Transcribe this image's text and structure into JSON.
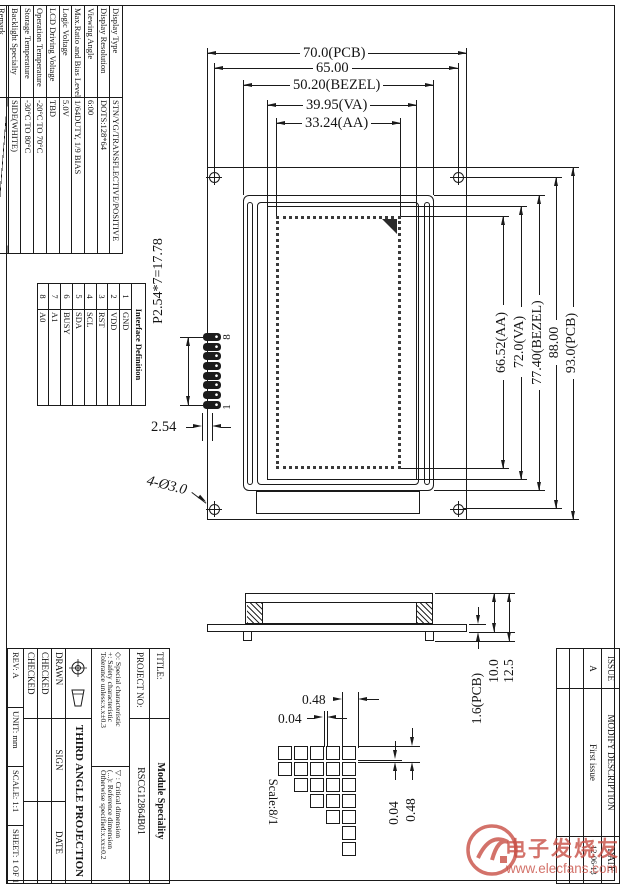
{
  "spec_table": {
    "rows": [
      {
        "label": "Display Type",
        "value": "STN/YG/TRANSFLECTIVE/POSITIVE"
      },
      {
        "label": "Display Resolution",
        "value": "DOTS:128*64"
      },
      {
        "label": "Viewing Angle",
        "value": "6:00"
      },
      {
        "label": "Max.Ratio and Bias Level",
        "value": "1/64DUTY, 1/9 BIAS"
      },
      {
        "label": "Logic Voltage",
        "value": "5.0V"
      },
      {
        "label": "LCD Driving Voltage",
        "value": "TBD"
      },
      {
        "label": "Operation Temperature",
        "value": "-20°C TO 70°C"
      },
      {
        "label": "Storage Temperature",
        "value": "-30°C TO 80°C"
      },
      {
        "label": "Backlight Specialty",
        "value": "SIDE(WHITE)"
      },
      {
        "label": "Remark",
        "value": ""
      }
    ]
  },
  "interface_table": {
    "title": "Interface Definition",
    "pins": [
      {
        "no": "1",
        "name": "GND"
      },
      {
        "no": "2",
        "name": "VDD"
      },
      {
        "no": "3",
        "name": "RST"
      },
      {
        "no": "4",
        "name": "SCL"
      },
      {
        "no": "5",
        "name": "SDA"
      },
      {
        "no": "6",
        "name": "BUSY"
      },
      {
        "no": "7",
        "name": "A1"
      },
      {
        "no": "8",
        "name": "A0"
      }
    ]
  },
  "dims": {
    "top": [
      "70.0(PCB)",
      "65.00",
      "50.20(BEZEL)",
      "39.95(VA)",
      "33.24(AA)"
    ],
    "right": [
      "66.52(AA)",
      "72.0(VA)",
      "77.40(BEZEL)",
      "88.00",
      "93.0(PCB)"
    ],
    "pin_pitch": "P2.54*7=17.78",
    "pin_gap": "2.54",
    "hole_note": "4-Ø3.0",
    "pin_top": "8",
    "pin_bottom": "1",
    "side": [
      "1.6(PCB)",
      "10.0",
      "12.5"
    ],
    "detail_top": [
      "0.48",
      "0.04"
    ],
    "detail_right": [
      "0.04",
      "0.48"
    ],
    "detail_scale": "Scale:8/1"
  },
  "title_block": {
    "title_label": "TITLE:",
    "title_value": "Module Speciality",
    "project_label": "PROJECT NO:",
    "project_value": "RSCG12864B01",
    "notes_left": [
      "◇: Special characteristic",
      "+: Safety characteristic",
      "Tolerance unless:x.x±0.3"
    ],
    "notes_right": [
      "▽ : Critical dimension",
      "(...): Reference dimension",
      "Otherwise specified:x.xx±0.2"
    ],
    "projection": "THIRD ANGLE PROJECTION",
    "drawn": "DRAWN",
    "checked1": "CHECKED",
    "checked2": "CHECKED",
    "sign": "SIGN",
    "date": "DATE",
    "rev": "REV: A",
    "unit": "UNIT: mm",
    "scale": "SCALE: 1:1",
    "sheet": "SHEET: 1 OF 1"
  },
  "issue_table": {
    "issue_label": "ISSUE",
    "modify_label": "MODIFY DESCRIPTION",
    "date_label": "DATE",
    "issue": "A",
    "modify": "First issue",
    "date": "12-06-13"
  },
  "watermark": {
    "brand": "电子发烧友",
    "url": "www.elecfans.com"
  }
}
